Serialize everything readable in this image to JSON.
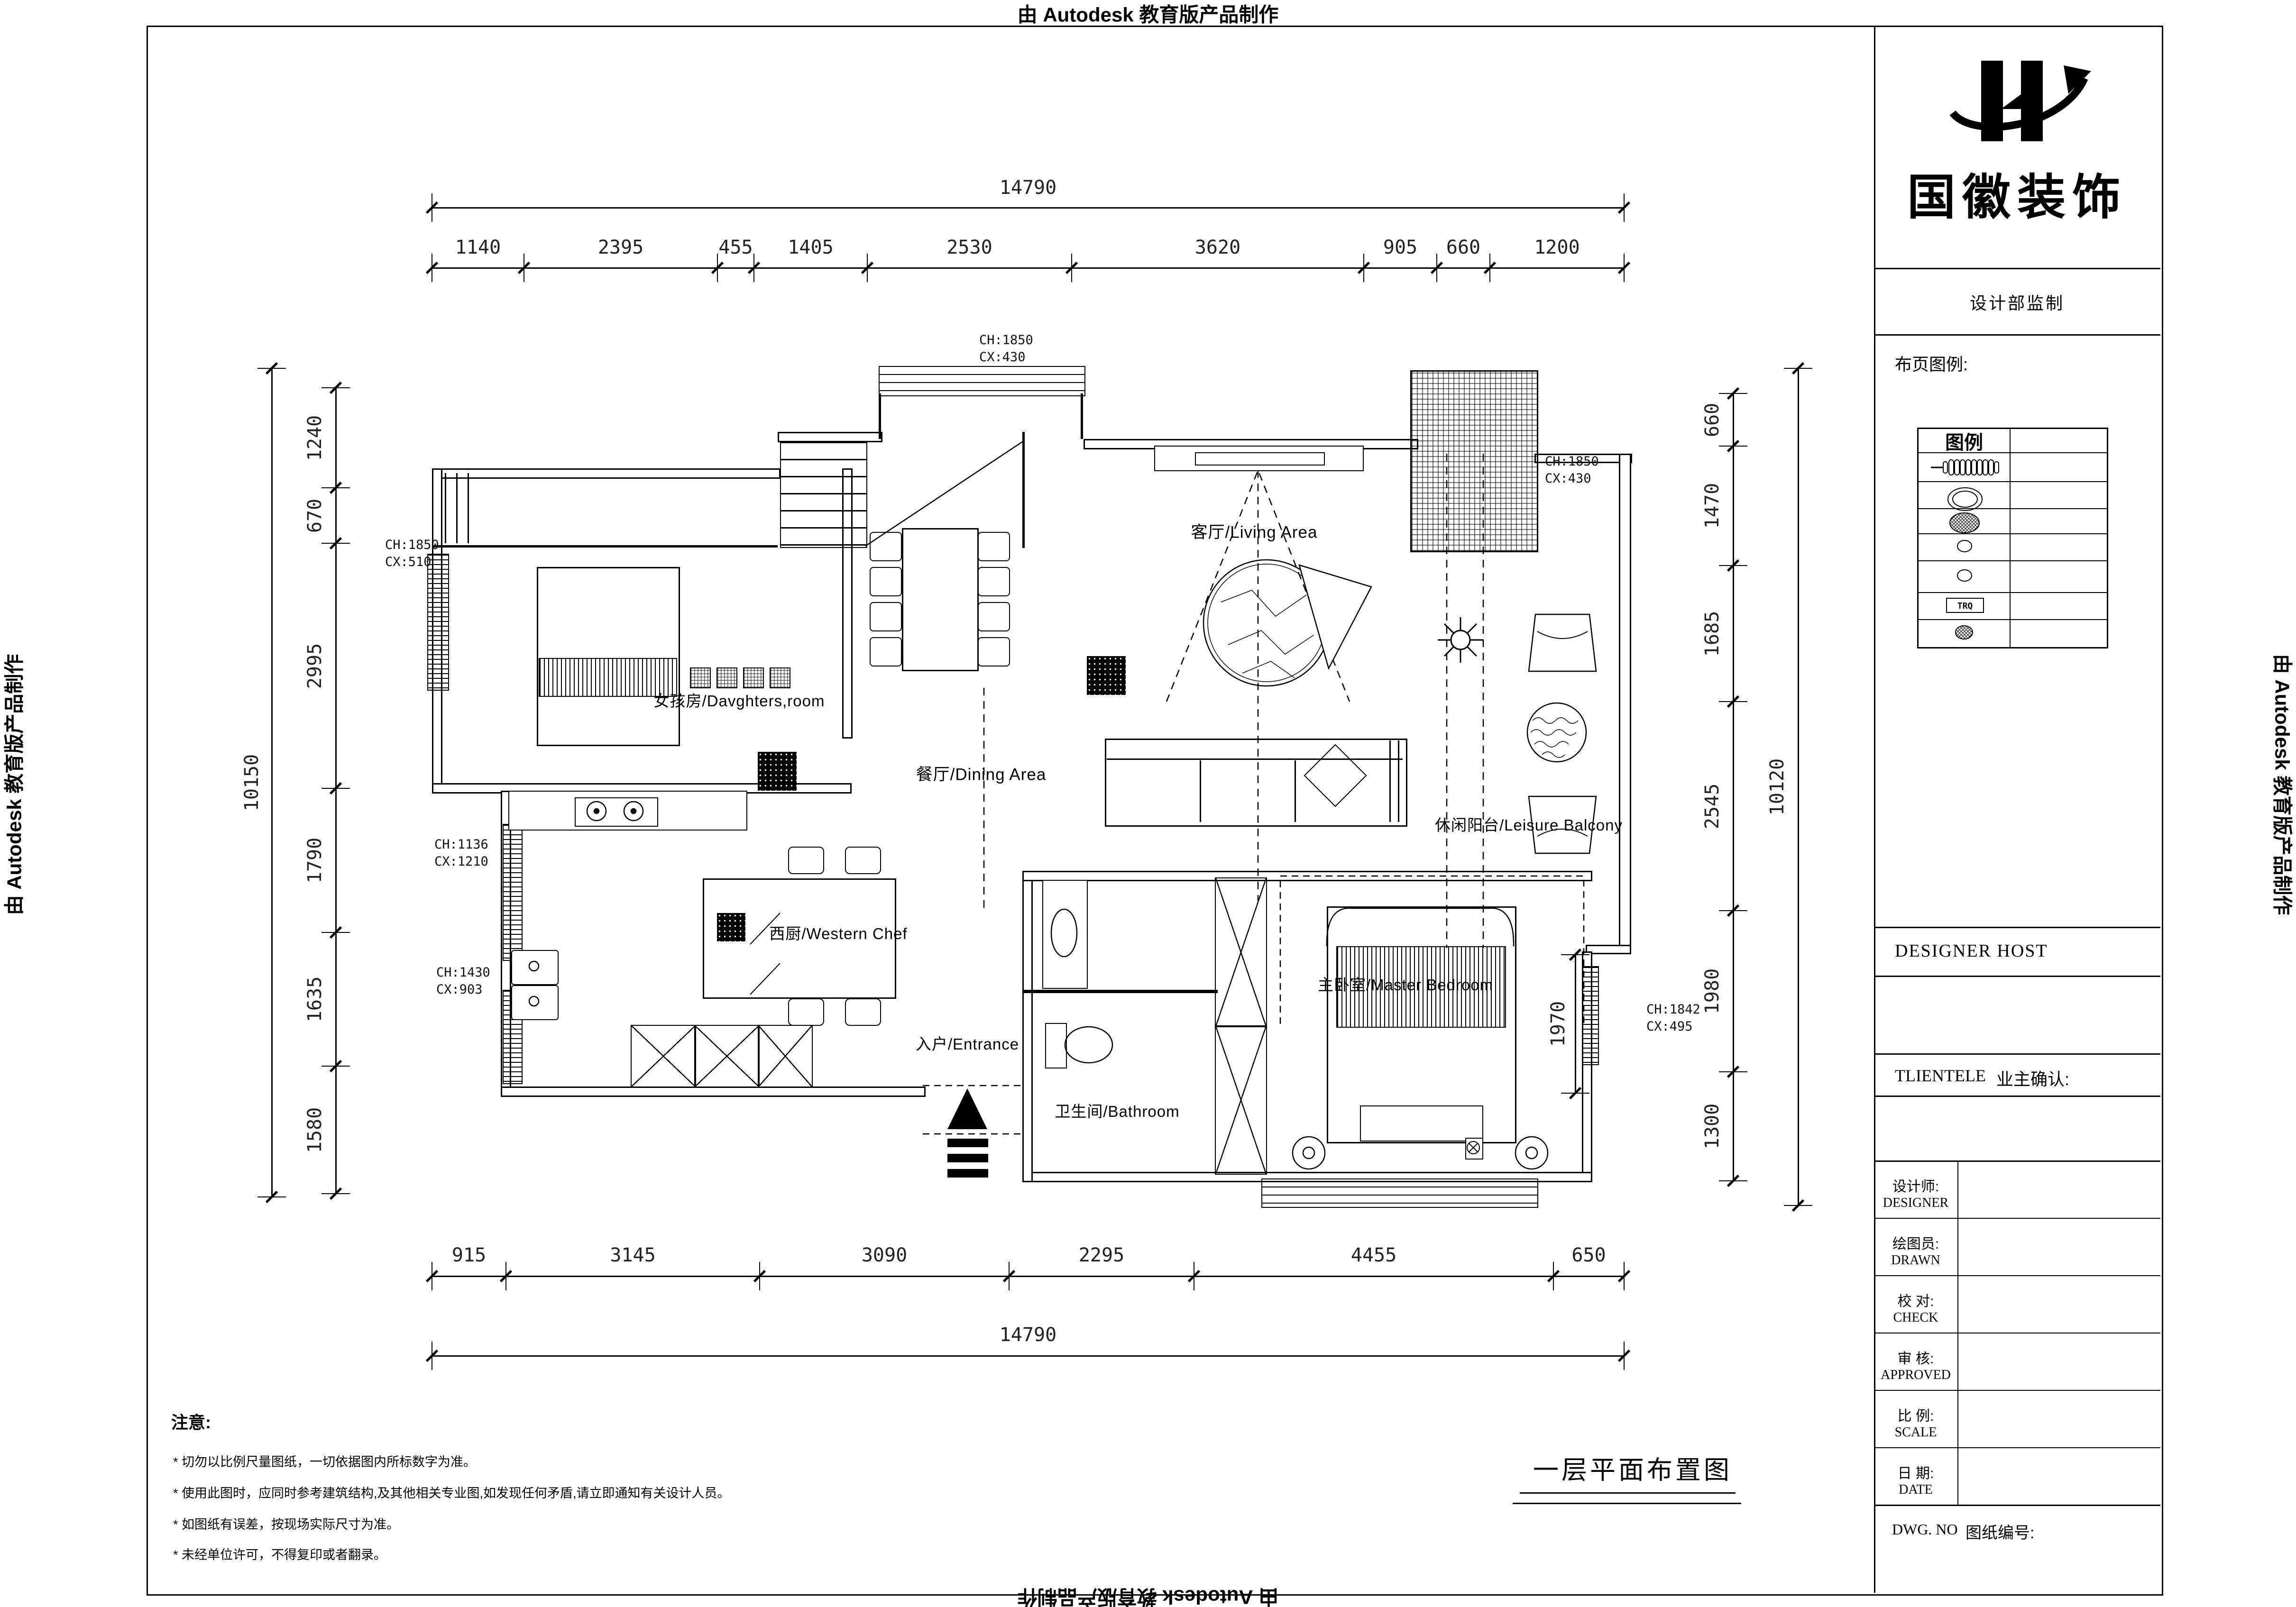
{
  "stamps": {
    "top": "由 Autodesk 教育版产品制作",
    "left": "由 Autodesk 教育版产品制作",
    "right": "由 Autodesk 教育版产品制作",
    "bottom": "由 Autodesk 教育版产品制作"
  },
  "title_block": {
    "company": "国徽装饰",
    "department": "设计部监制",
    "legend_section_label": "布页图例:",
    "legend_header": "图例",
    "legend_trq": "TRQ",
    "legend_rows": [
      {
        "symbol": "radiator-coil-icon"
      },
      {
        "symbol": "double-ellipse-icon"
      },
      {
        "symbol": "crosshatch-ellipse-icon"
      },
      {
        "symbol": "small-ellipse-icon"
      },
      {
        "symbol": "small-ellipse-icon"
      },
      {
        "symbol": "trq-box-icon"
      },
      {
        "symbol": "hatched-ellipse-icon"
      }
    ],
    "designer_host": "DESIGNER HOST",
    "clientele": "TLIENTELE",
    "owner_confirm": "业主确认:",
    "rows": [
      {
        "cn": "设计师:",
        "en": "DESIGNER"
      },
      {
        "cn": "绘图员:",
        "en": "DRAWN"
      },
      {
        "cn": "校 对:",
        "en": "CHECK"
      },
      {
        "cn": "审 核:",
        "en": "APPROVED"
      },
      {
        "cn": "比 例:",
        "en": "SCALE"
      },
      {
        "cn": "日 期:",
        "en": "DATE"
      }
    ],
    "dwg_no": "DWG. NO",
    "sheet_no_label": "图纸编号:"
  },
  "plan_title": "一层平面布置图",
  "notes": {
    "heading": "注意:",
    "items": [
      "* 切勿以比例尺量图纸，一切依据图内所标数字为准。",
      "* 使用此图时，应同时参考建筑结构,及其他相关专业图,如发现任何矛盾,请立即通知有关设计人员。",
      "* 如图纸有误差，按现场实际尺寸为准。",
      "* 未经单位许可，不得复印或者翻录。"
    ]
  },
  "rooms": [
    {
      "label": "女孩房/Davghters,room"
    },
    {
      "label": "餐厅/Dining Area"
    },
    {
      "label": "客厅/Living Area"
    },
    {
      "label": "西厨/Western Chef"
    },
    {
      "label": "入户/Entrance"
    },
    {
      "label": "卫生间/Bathroom"
    },
    {
      "label": "主卧室/Master Bedroom"
    },
    {
      "label": "休闲阳台/Leisure Balcony"
    }
  ],
  "annotations": [
    {
      "l1": "CH:1850",
      "l2": "CX:430"
    },
    {
      "l1": "CH:1850",
      "l2": "CX:430"
    },
    {
      "l1": "CH:1850",
      "l2": "CX:510"
    },
    {
      "l1": "CH:1136",
      "l2": "CX:1210"
    },
    {
      "l1": "CH:1430",
      "l2": "CX:903"
    },
    {
      "l1": "CH:1842",
      "l2": "CX:495"
    }
  ],
  "dimensions": {
    "top": {
      "total": "14790",
      "segments": [
        "1140",
        "2395",
        "455",
        "1405",
        "2530",
        "3620",
        "905",
        "660",
        "1200"
      ]
    },
    "bottom": {
      "total": "14790",
      "segments": [
        "915",
        "3145",
        "3090",
        "2295",
        "4455",
        "650"
      ]
    },
    "left": {
      "total": "10150",
      "segments": [
        "1240",
        "670",
        "2995",
        "1790",
        "1635",
        "1580"
      ]
    },
    "right": {
      "total": "10120",
      "segments": [
        "660",
        "1470",
        "1685",
        "2545",
        "1980",
        "1300"
      ]
    },
    "interior": [
      "1970"
    ]
  }
}
